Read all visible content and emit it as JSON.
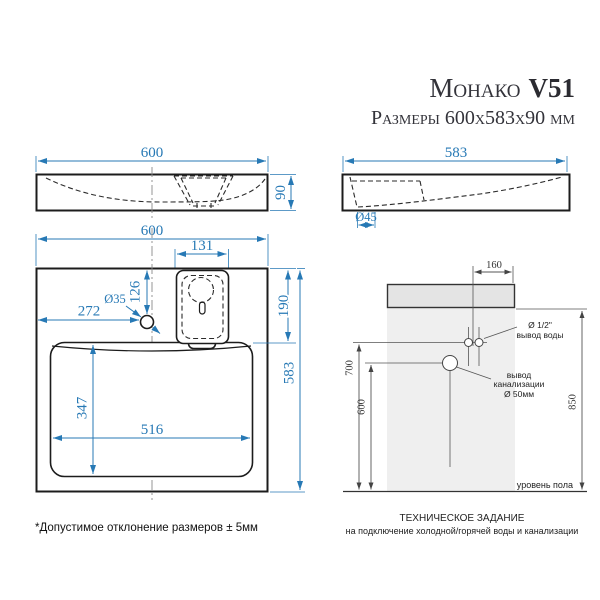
{
  "title": {
    "name": "Монако",
    "model": "V51",
    "subtitle": "Размеры 600х583х90 мм"
  },
  "front_view": {
    "width": "600",
    "height": "90"
  },
  "side_view": {
    "depth": "583",
    "faucet_hole_dia": "Ø45"
  },
  "plan_view": {
    "width": "600",
    "dispenser_width": "131",
    "hole_offset_top": "126",
    "hole_dia": "Ø35",
    "hole_offset_left": "272",
    "dispenser_depth": "190",
    "depth": "583",
    "bowl_depth": "347",
    "bowl_width": "516"
  },
  "installation": {
    "water_offset": "160",
    "water_height": "700",
    "drain_height": "600",
    "total_height": "850",
    "water_line1": "Ø 1/2\"",
    "water_line2": "вывод воды",
    "drain_line1": "вывод",
    "drain_line2": "канализации",
    "drain_line3": "Ø 50мм",
    "floor_label": "уровень пола",
    "caption_line1": "ТЕХНИЧЕСКОЕ ЗАДАНИЕ",
    "caption_line2": "на подключение холодной/горячей воды и канализации"
  },
  "footnote": "*Допустимое отклонение размеров ± 5мм",
  "colors": {
    "dimension_blue": "#2779b5",
    "drawing_line": "#1c1c1c",
    "install_line": "#555555",
    "sink_fill": "#e4e4e4",
    "wall_fill": "#efefef",
    "title_text": "#33333a"
  }
}
